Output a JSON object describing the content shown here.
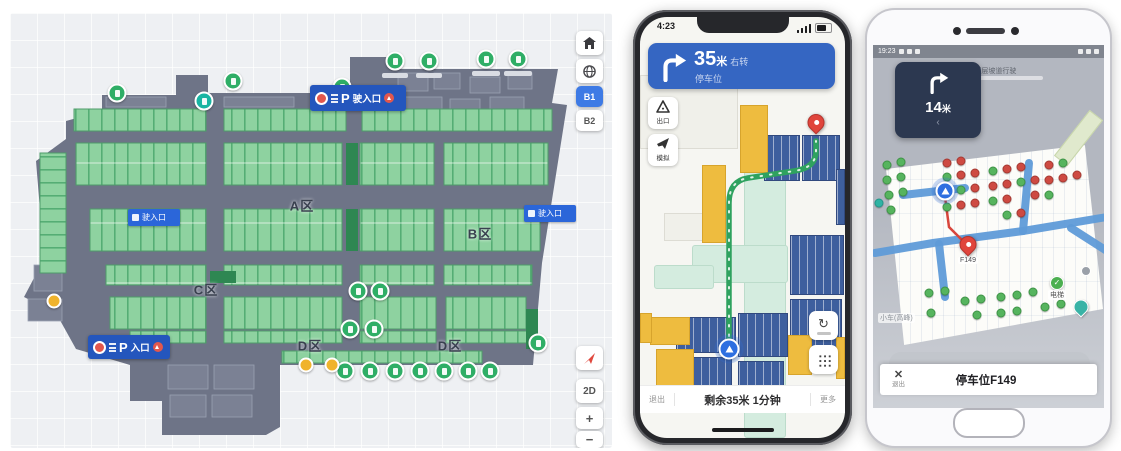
{
  "map_panel": {
    "floor_polygon": "92,98 92,82 166,82 166,62 198,62 198,80 340,80 340,44 382,44 382,56 548,56 542,90 557,92 532,250 523,352 270,352 270,414 256,422 152,422 152,388 120,388 120,352 66,336 46,300 14,284 34,246 26,148 56,126 56,108",
    "stall_banks": [
      [
        64,
        96,
        132,
        22
      ],
      [
        214,
        96,
        122,
        22
      ],
      [
        352,
        96,
        190,
        22
      ],
      [
        66,
        130,
        130,
        42
      ],
      [
        214,
        130,
        118,
        42
      ],
      [
        350,
        130,
        74,
        42
      ],
      [
        434,
        130,
        104,
        42
      ],
      [
        80,
        196,
        116,
        42
      ],
      [
        214,
        196,
        118,
        42
      ],
      [
        350,
        196,
        74,
        42
      ],
      [
        434,
        196,
        96,
        42
      ],
      [
        96,
        252,
        100,
        20
      ],
      [
        214,
        252,
        118,
        20
      ],
      [
        350,
        252,
        74,
        20
      ],
      [
        434,
        252,
        88,
        20
      ],
      [
        100,
        284,
        96,
        32
      ],
      [
        214,
        284,
        118,
        32
      ],
      [
        350,
        284,
        76,
        32
      ],
      [
        436,
        284,
        80,
        32
      ],
      [
        120,
        318,
        76,
        12
      ],
      [
        214,
        318,
        118,
        12
      ],
      [
        350,
        318,
        76,
        12
      ],
      [
        436,
        318,
        84,
        12
      ],
      [
        272,
        338,
        200,
        12
      ],
      [
        30,
        140,
        26,
        120,
        "v"
      ]
    ],
    "dark_blocks": [
      [
        336,
        130,
        12,
        42
      ],
      [
        200,
        258,
        26,
        12
      ],
      [
        516,
        296,
        12,
        40
      ],
      [
        336,
        196,
        12,
        42
      ]
    ],
    "rooms": [
      [
        388,
        60,
        30,
        18
      ],
      [
        424,
        60,
        26,
        16
      ],
      [
        460,
        64,
        30,
        16
      ],
      [
        498,
        60,
        24,
        16
      ],
      [
        392,
        84,
        40,
        12
      ],
      [
        440,
        86,
        30,
        12
      ],
      [
        480,
        84,
        34,
        12
      ],
      [
        158,
        352,
        40,
        24
      ],
      [
        204,
        352,
        40,
        24
      ],
      [
        160,
        382,
        36,
        22
      ],
      [
        202,
        382,
        40,
        22
      ],
      [
        24,
        252,
        28,
        26
      ],
      [
        18,
        286,
        34,
        22
      ],
      [
        96,
        84,
        60,
        10
      ],
      [
        214,
        84,
        70,
        10
      ]
    ],
    "zones": [
      {
        "label": "A区",
        "x": 292,
        "y": 192
      },
      {
        "label": "B区",
        "x": 470,
        "y": 220
      },
      {
        "label": "C区",
        "x": 196,
        "y": 276
      },
      {
        "label": "D区",
        "x": 300,
        "y": 332
      },
      {
        "label": "D区",
        "x": 440,
        "y": 332
      }
    ],
    "signs": [
      {
        "type": "large",
        "p": "P",
        "label": "驶入口",
        "x": 300,
        "y": 72,
        "w": 96,
        "h": 26
      },
      {
        "type": "large",
        "p": "P",
        "label": "入口",
        "x": 78,
        "y": 322,
        "w": 82,
        "h": 24
      },
      {
        "type": "small",
        "label": "驶入口",
        "x": 118,
        "y": 196,
        "w": 52,
        "h": 17
      },
      {
        "type": "small",
        "label": "驶入口",
        "x": 514,
        "y": 192,
        "w": 52,
        "h": 17
      }
    ],
    "markers": [
      {
        "x": 385,
        "y": 48,
        "t": "g"
      },
      {
        "x": 419,
        "y": 48,
        "t": "g"
      },
      {
        "x": 476,
        "y": 46,
        "t": "g"
      },
      {
        "x": 508,
        "y": 46,
        "t": "g"
      },
      {
        "x": 223,
        "y": 68,
        "t": "g"
      },
      {
        "x": 332,
        "y": 74,
        "t": "g"
      },
      {
        "x": 107,
        "y": 80,
        "t": "g"
      },
      {
        "x": 194,
        "y": 88,
        "t": "t"
      },
      {
        "x": 348,
        "y": 278,
        "t": "g"
      },
      {
        "x": 370,
        "y": 278,
        "t": "g"
      },
      {
        "x": 340,
        "y": 316,
        "t": "g"
      },
      {
        "x": 364,
        "y": 316,
        "t": "g"
      },
      {
        "x": 335,
        "y": 358,
        "t": "g"
      },
      {
        "x": 360,
        "y": 358,
        "t": "g"
      },
      {
        "x": 385,
        "y": 358,
        "t": "g"
      },
      {
        "x": 410,
        "y": 358,
        "t": "g"
      },
      {
        "x": 434,
        "y": 358,
        "t": "g"
      },
      {
        "x": 458,
        "y": 358,
        "t": "g"
      },
      {
        "x": 480,
        "y": 358,
        "t": "g"
      },
      {
        "x": 528,
        "y": 330,
        "t": "g"
      },
      {
        "x": 44,
        "y": 288,
        "t": "y"
      },
      {
        "x": 296,
        "y": 352,
        "t": "y"
      },
      {
        "x": 322,
        "y": 352,
        "t": "y"
      }
    ],
    "label_chips": [
      [
        372,
        60,
        26
      ],
      [
        406,
        60,
        26
      ],
      [
        462,
        58,
        28
      ],
      [
        494,
        58,
        28
      ]
    ],
    "controls": {
      "floor1": "B1",
      "floor2": "B2",
      "mode2d": "2D",
      "zoom_in": "+",
      "zoom_out": "−"
    }
  },
  "phone_nav": {
    "time": "4:23",
    "banner": {
      "distance": "35",
      "unit": "米",
      "suffix": "右转",
      "sub": "停车位"
    },
    "side_buttons": [
      {
        "label": "出口"
      },
      {
        "label": "模拟"
      }
    ],
    "map": {
      "walls": [
        [
          0,
          58,
          96,
          72
        ],
        [
          24,
          196,
          60,
          26
        ]
      ],
      "teal": [
        [
          104,
          140,
          40,
          279
        ],
        [
          52,
          228,
          94,
          36
        ],
        [
          14,
          248,
          58,
          22
        ]
      ],
      "blue": [
        [
          124,
          118,
          34,
          44
        ],
        [
          162,
          118,
          36,
          44
        ],
        [
          150,
          218,
          52,
          58
        ],
        [
          150,
          282,
          50,
          52
        ],
        [
          36,
          300,
          58,
          34
        ],
        [
          36,
          340,
          54,
          44
        ],
        [
          98,
          296,
          48,
          42
        ],
        [
          98,
          344,
          44,
          40
        ],
        [
          196,
          152,
          7,
          54
        ]
      ],
      "yellow": [
        [
          100,
          88,
          26,
          66
        ],
        [
          62,
          148,
          22,
          76
        ],
        [
          10,
          300,
          38,
          26
        ],
        [
          16,
          332,
          36,
          44
        ],
        [
          148,
          318,
          22,
          38
        ],
        [
          196,
          320,
          7,
          40
        ],
        [
          0,
          296,
          10,
          28
        ]
      ],
      "route": "M89,338 L89,186 Q89,164 108,161 L154,154 Q176,151 176,134 L176,124",
      "pin": {
        "x": 176,
        "y": 114
      },
      "puck": {
        "x": 89,
        "y": 332
      }
    },
    "bottom": {
      "left": "退出",
      "center": "剩余35米 1分钟",
      "right": "更多"
    }
  },
  "phone_spot": {
    "time": "19:23",
    "card": {
      "distance": "14",
      "unit": "米",
      "back": "‹"
    },
    "hint": "←(下层坡道行驶",
    "pin_label": "F149",
    "poi_label": "电梯",
    "poi_check": "✓",
    "corner_label": "小车(高峰)",
    "bottom": {
      "close": "✕",
      "close_label": "退出",
      "title": "停车位F149"
    },
    "lanes": [
      "M2,208 L60,198 L150,186 L234,172",
      "M66,199 L72,252",
      "M30,150 L92,143",
      "M150,186 L156,118",
      "M198,183 L234,206"
    ],
    "route": "M72,152 L76,182 L92,198 L95,206",
    "puck": {
      "x": 72,
      "y": 146
    },
    "pin": {
      "x": 95,
      "y": 208
    },
    "spots": [
      [
        14,
        120,
        "g"
      ],
      [
        28,
        117,
        "g"
      ],
      [
        14,
        135,
        "g"
      ],
      [
        28,
        132,
        "g"
      ],
      [
        16,
        150,
        "g"
      ],
      [
        30,
        147,
        "g"
      ],
      [
        18,
        165,
        "g"
      ],
      [
        6,
        158,
        "t"
      ],
      [
        74,
        118,
        "r"
      ],
      [
        88,
        116,
        "r"
      ],
      [
        74,
        132,
        "g"
      ],
      [
        88,
        130,
        "r"
      ],
      [
        102,
        128,
        "r"
      ],
      [
        74,
        147,
        "r"
      ],
      [
        88,
        145,
        "g"
      ],
      [
        102,
        143,
        "r"
      ],
      [
        88,
        160,
        "r"
      ],
      [
        102,
        158,
        "r"
      ],
      [
        74,
        162,
        "g"
      ],
      [
        120,
        126,
        "g"
      ],
      [
        134,
        124,
        "r"
      ],
      [
        148,
        122,
        "r"
      ],
      [
        120,
        141,
        "r"
      ],
      [
        134,
        139,
        "r"
      ],
      [
        148,
        137,
        "g"
      ],
      [
        162,
        135,
        "r"
      ],
      [
        120,
        156,
        "g"
      ],
      [
        134,
        154,
        "r"
      ],
      [
        162,
        150,
        "r"
      ],
      [
        148,
        168,
        "r"
      ],
      [
        134,
        170,
        "g"
      ],
      [
        176,
        120,
        "r"
      ],
      [
        190,
        118,
        "g"
      ],
      [
        176,
        135,
        "r"
      ],
      [
        190,
        133,
        "r"
      ],
      [
        176,
        150,
        "g"
      ],
      [
        204,
        130,
        "r"
      ],
      [
        56,
        248,
        "g"
      ],
      [
        72,
        246,
        "g"
      ],
      [
        92,
        256,
        "g"
      ],
      [
        108,
        254,
        "g"
      ],
      [
        128,
        252,
        "g"
      ],
      [
        144,
        250,
        "g"
      ],
      [
        160,
        247,
        "g"
      ],
      [
        128,
        268,
        "g"
      ],
      [
        144,
        266,
        "g"
      ],
      [
        104,
        270,
        "g"
      ],
      [
        172,
        262,
        "g"
      ],
      [
        188,
        259,
        "g"
      ],
      [
        58,
        268,
        "g"
      ]
    ]
  }
}
